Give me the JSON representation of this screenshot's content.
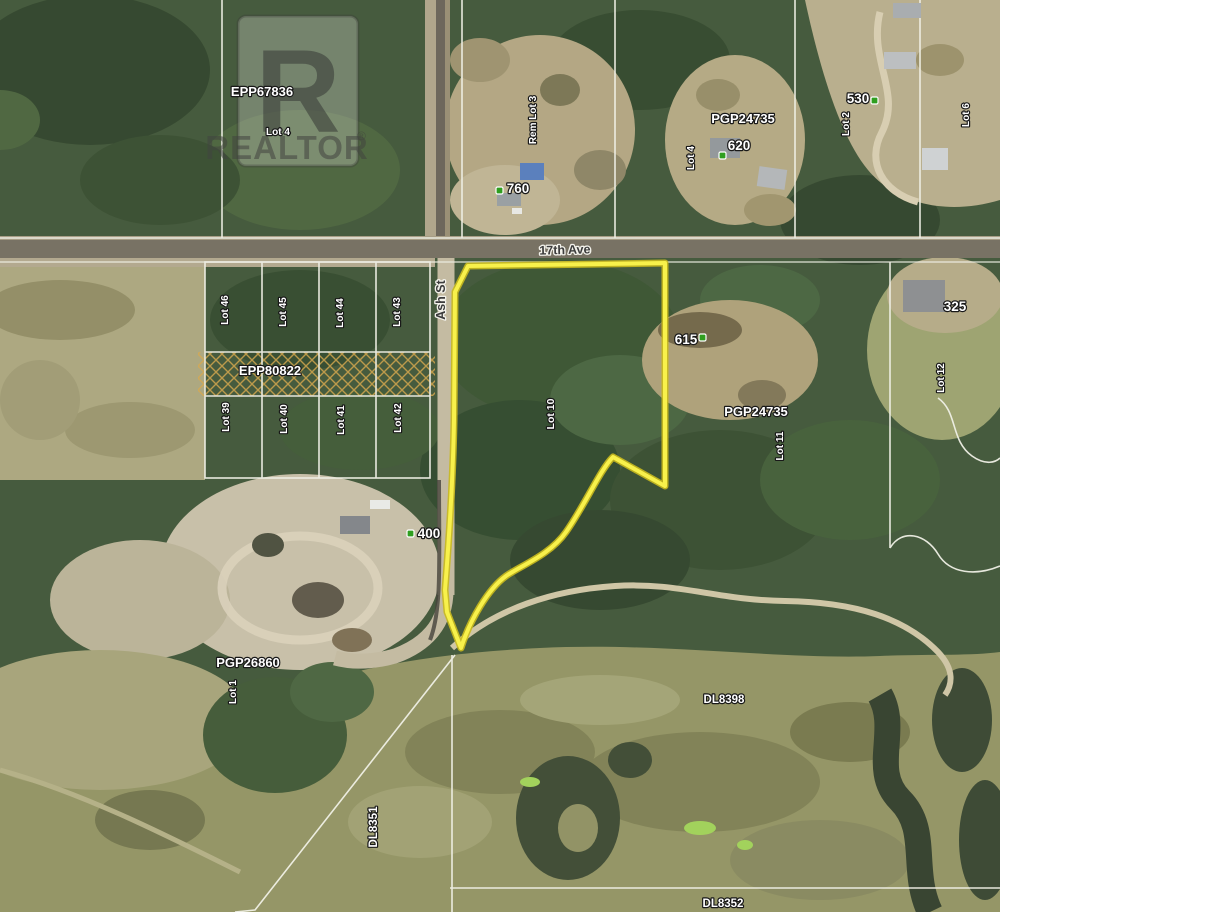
{
  "brand": {
    "letter": "R",
    "name": "REALTOR",
    "registered": "®"
  },
  "streets": {
    "ave_17th": "17th Ave",
    "ash": "Ash St"
  },
  "plans": {
    "epp67836": "EPP67836",
    "pgp24735_north": "PGP24735",
    "epp80822": "EPP80822",
    "pgp24735_mid": "PGP24735",
    "pgp26860": "PGP26860"
  },
  "districts": {
    "dl8351": "DL8351",
    "dl8398": "DL8398",
    "dl8352": "DL8352"
  },
  "addresses": {
    "a760": "760",
    "a620": "620",
    "a530": "530",
    "a615": "615",
    "a325": "325",
    "a400": "400"
  },
  "lots": {
    "epp67836_lot": "Lot 4",
    "rem_lot_3": "Rem Lot 3",
    "north_lot_4": "Lot 4",
    "north_lot_2": "Lot 2",
    "north_lot_6": "Lot 6",
    "row1": [
      "Lot 46",
      "Lot 45",
      "Lot 44",
      "Lot 43"
    ],
    "row2": [
      "Lot 39",
      "Lot 40",
      "Lot 41",
      "Lot 42"
    ],
    "subject": "Lot 10",
    "mid_lot_11": "Lot 11",
    "east_lot_12": "Lot 12",
    "south_lot_1": "Lot 1"
  },
  "colors": {
    "subject_outline": "#f8f14b",
    "subject_outline_shadow": "#c9ba1e",
    "marker_green": "#2f9e1f",
    "hatch_orange": "#d9a94f",
    "parcel_line": "#f0f0e6"
  }
}
